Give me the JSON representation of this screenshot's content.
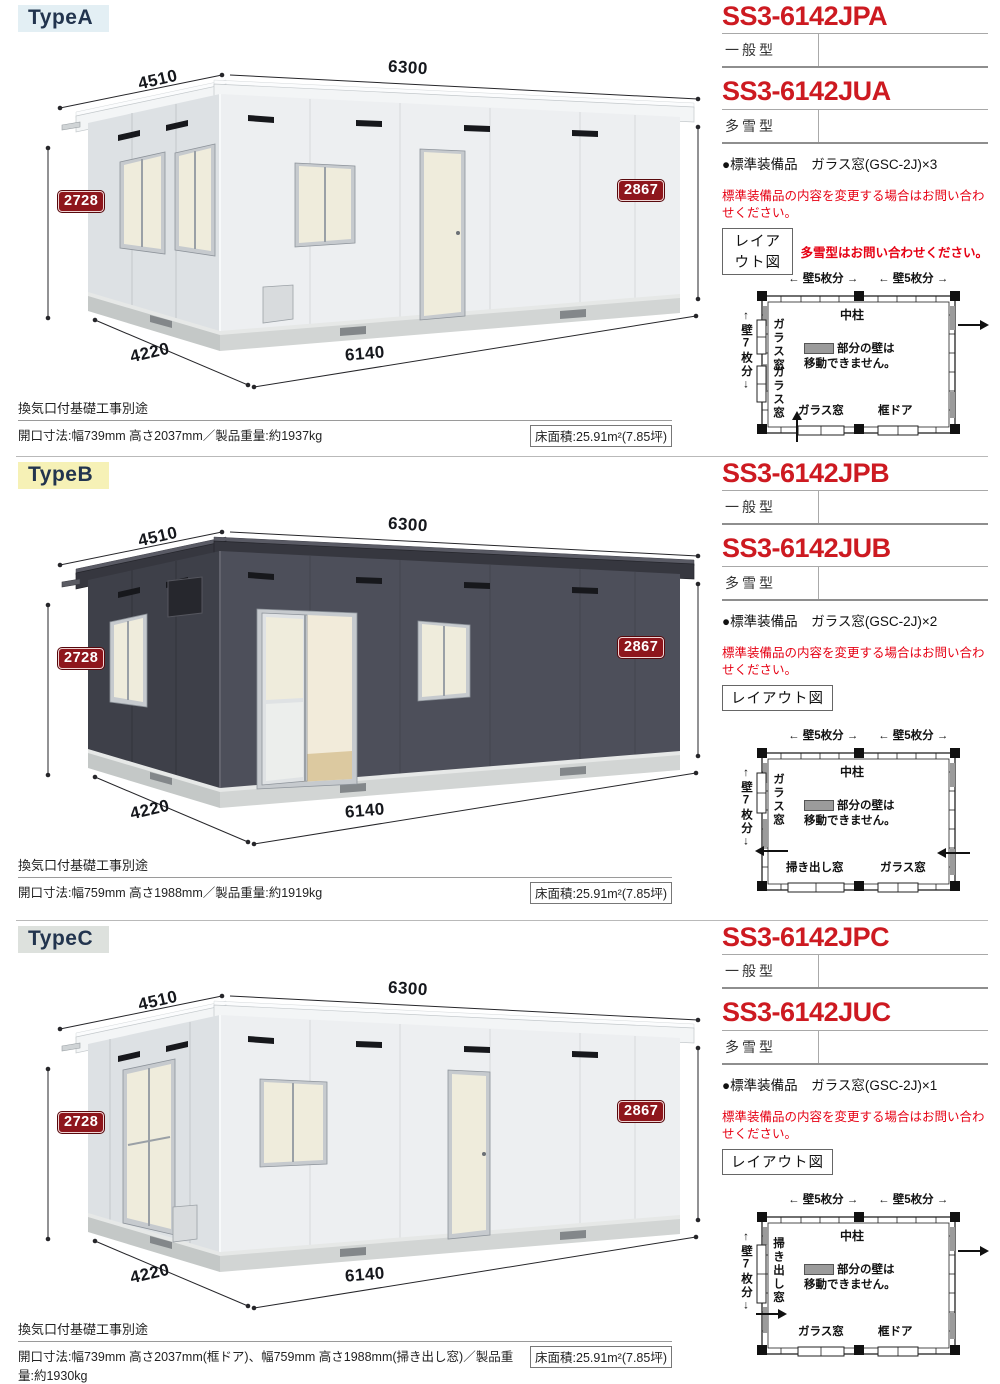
{
  "sections": [
    {
      "type_label": "TypeA",
      "label_bg": "#e3eff4",
      "codes": [
        {
          "code": "SS3-6142JPA",
          "category": "一般型"
        },
        {
          "code": "SS3-6142JUA",
          "category": "多雪型"
        }
      ],
      "equipment": "●標準装備品　ガラス窓(GSC-2J)×3",
      "warning": "標準装備品の内容を変更する場合はお問い合わせください。",
      "layout_button": "レイアウト図",
      "layout_note": "多雪型はお問い合わせください。",
      "dims": {
        "width_left": "4510",
        "width_right": "6300",
        "height_left": "2728",
        "height_right": "2867",
        "base_left": "4220",
        "base_right": "6140"
      },
      "notes_line": "換気口付基礎工事別途",
      "spec": "開口寸法:幅739mm 高さ2037mm／製品重量:約1937kg",
      "floor_area": "床面積:25.91m²(7.85坪)",
      "plan": {
        "top_span_1": "← 壁5枚分 →",
        "top_span_2": "← 壁5枚分 →",
        "left_span": "↑壁7枚分↓",
        "wall_label_1": "ガラス窓",
        "wall_label_2": "ガラス窓",
        "center_post": "中柱",
        "legend_line_1": "部分の壁は",
        "legend_line_2": "移動できません。",
        "bottom_left": "ガラス窓",
        "bottom_right": "框ドア"
      }
    },
    {
      "type_label": "TypeB",
      "label_bg": "#f6f1b6",
      "codes": [
        {
          "code": "SS3-6142JPB",
          "category": "一般型"
        },
        {
          "code": "SS3-6142JUB",
          "category": "多雪型"
        }
      ],
      "equipment": "●標準装備品　ガラス窓(GSC-2J)×2",
      "warning": "標準装備品の内容を変更する場合はお問い合わせください。",
      "layout_button": "レイアウト図",
      "dims": {
        "width_left": "4510",
        "width_right": "6300",
        "height_left": "2728",
        "height_right": "2867",
        "base_left": "4220",
        "base_right": "6140"
      },
      "notes_line": "換気口付基礎工事別途",
      "spec": "開口寸法:幅759mm 高さ1988mm／製品重量:約1919kg",
      "floor_area": "床面積:25.91m²(7.85坪)",
      "plan": {
        "top_span_1": "← 壁5枚分 →",
        "top_span_2": "← 壁5枚分 →",
        "left_span": "↑壁7枚分↓",
        "wall_label_1": "ガラス窓",
        "center_post": "中柱",
        "legend_line_1": "部分の壁は",
        "legend_line_2": "移動できません。",
        "bottom_left": "掃き出し窓",
        "bottom_right": "ガラス窓"
      }
    },
    {
      "type_label": "TypeC",
      "label_bg": "#dde1dd",
      "codes": [
        {
          "code": "SS3-6142JPC",
          "category": "一般型"
        },
        {
          "code": "SS3-6142JUC",
          "category": "多雪型"
        }
      ],
      "equipment": "●標準装備品　ガラス窓(GSC-2J)×1",
      "warning": "標準装備品の内容を変更する場合はお問い合わせください。",
      "layout_button": "レイアウト図",
      "dims": {
        "width_left": "4510",
        "width_right": "6300",
        "height_left": "2728",
        "height_right": "2867",
        "base_left": "4220",
        "base_right": "6140"
      },
      "notes_line": "換気口付基礎工事別途",
      "spec": "開口寸法:幅739mm 高さ2037mm(框ドア)、幅759mm 高さ1988mm(掃き出し窓)／製品重量:約1930kg",
      "floor_area": "床面積:25.91m²(7.85坪)",
      "plan": {
        "top_span_1": "← 壁5枚分 →",
        "top_span_2": "← 壁5枚分 →",
        "left_span": "↑壁7枚分↓",
        "wall_label_1": "掃き出し窓",
        "center_post": "中柱",
        "legend_line_1": "部分の壁は",
        "legend_line_2": "移動できません。",
        "bottom_left": "ガラス窓",
        "bottom_right": "框ドア"
      }
    }
  ]
}
